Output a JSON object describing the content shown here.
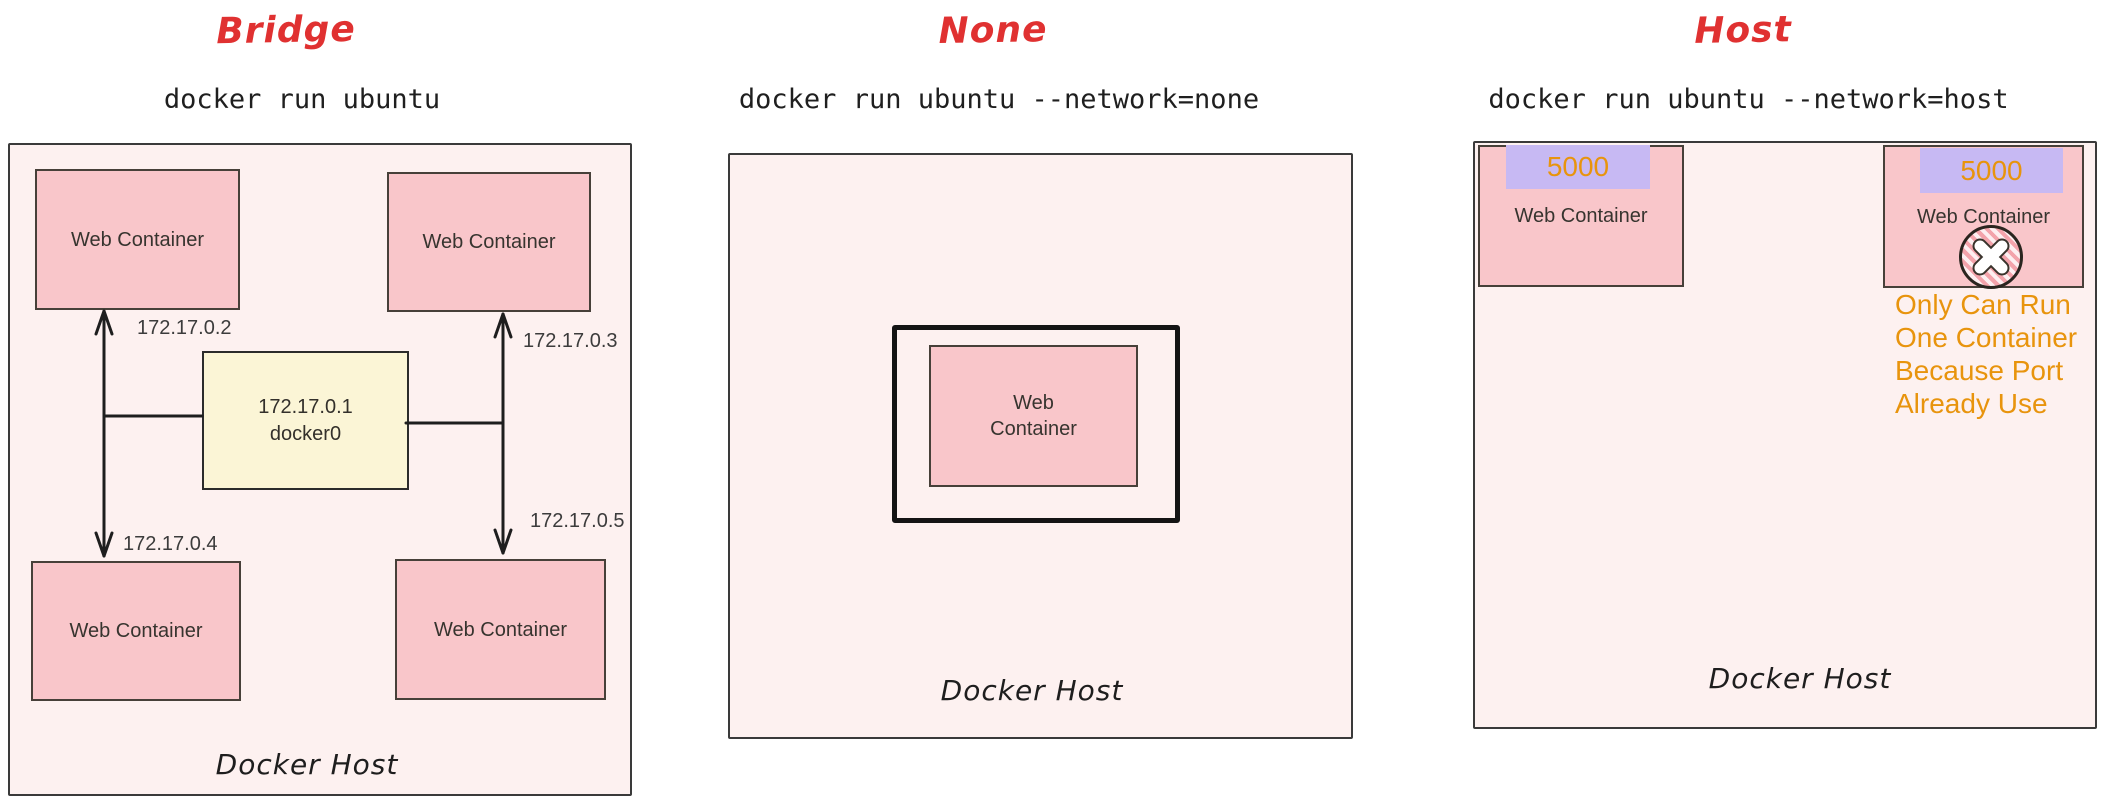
{
  "labels": {
    "web_container": "Web Container",
    "docker_host": "Docker Host"
  },
  "panels": {
    "bridge": {
      "title": "Bridge",
      "command": "docker run ubuntu",
      "gateway": {
        "ip": "172.17.0.1",
        "name": "docker0"
      },
      "container_ips": {
        "top_left": "172.17.0.2",
        "top_right": "172.17.0.3",
        "bottom_left": "172.17.0.4",
        "bottom_right": "172.17.0.5"
      }
    },
    "none": {
      "title": "None",
      "command": "docker run ubuntu --network=none"
    },
    "host": {
      "title": "Host",
      "command": "docker run ubuntu --network=host",
      "port": "5000",
      "warning_lines": [
        "Only Can Run",
        "One Container",
        "Because Port",
        "Already Use"
      ]
    }
  },
  "colors": {
    "title_red": "#e03131",
    "panel_bg": "#fdf1f0",
    "container_pink": "#f9c6ca",
    "gateway_yellow": "#fbf5d6",
    "port_badge_lavender": "#c7b9f3",
    "warning_orange": "#e8940d",
    "line_black": "#1e1e1e"
  }
}
